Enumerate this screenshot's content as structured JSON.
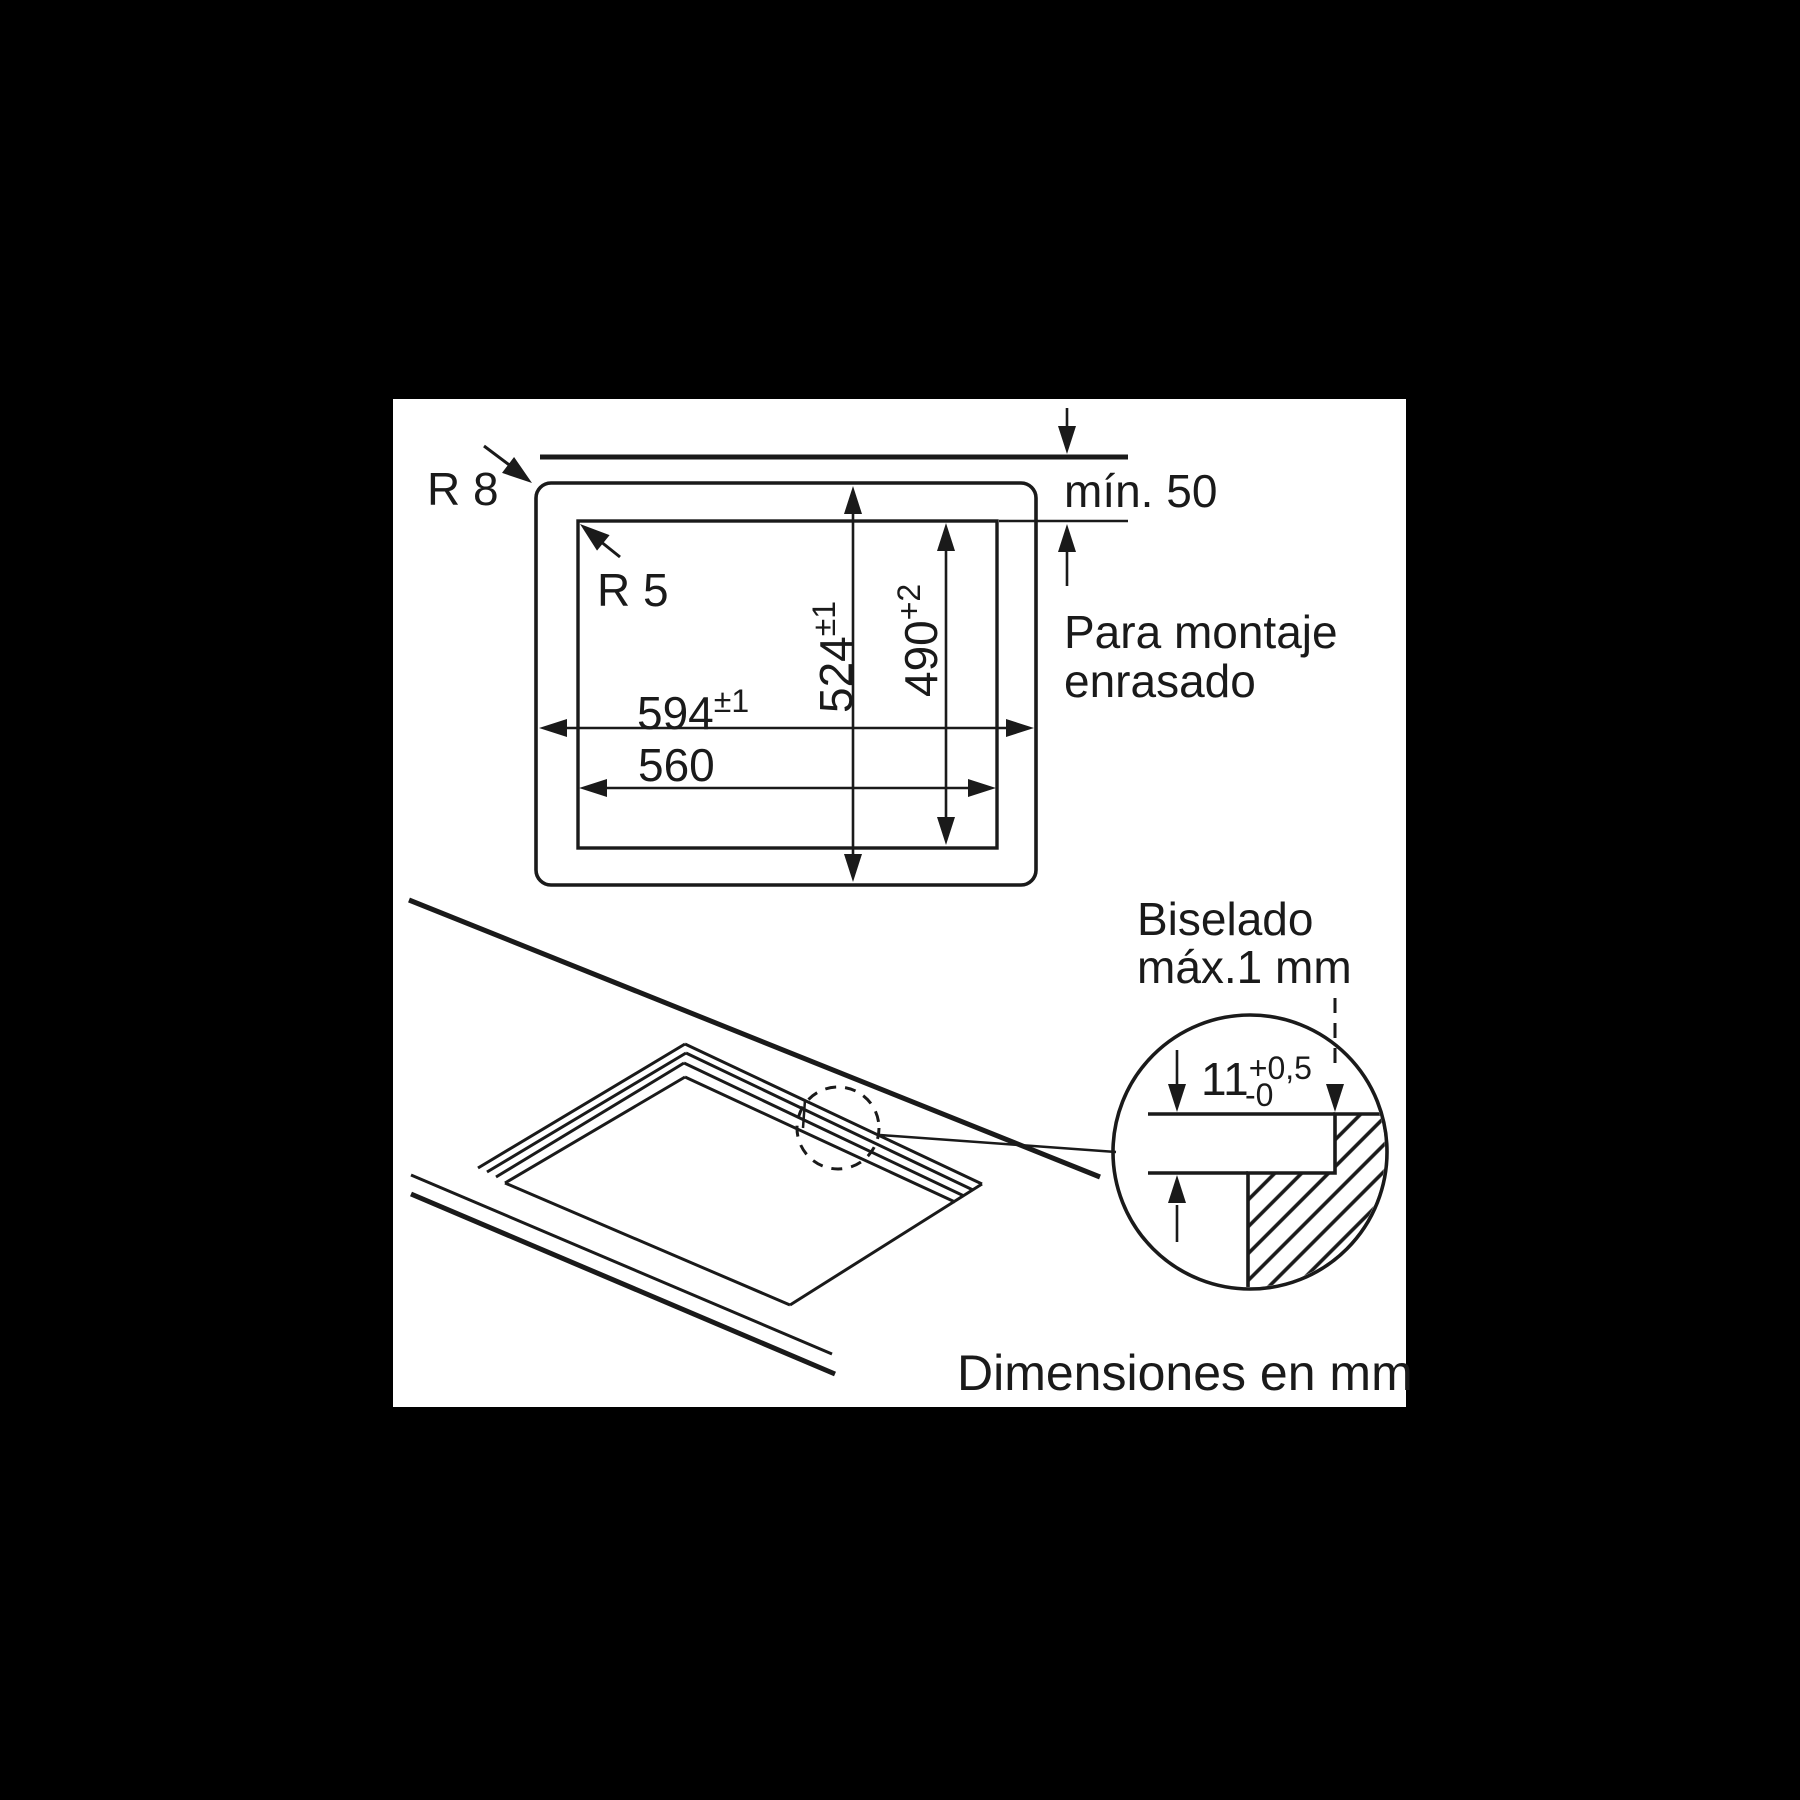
{
  "colors": {
    "page_bg": "#000000",
    "canvas_bg": "#ffffff",
    "line": "#1a1a1a"
  },
  "top_view": {
    "outer_corner_radius": "R 8",
    "inner_corner_radius": "R 5",
    "min_clearance": "mín. 50",
    "hob_width": "594",
    "hob_width_tol": "±1",
    "cutout_width": "560",
    "hob_depth": "524",
    "hob_depth_tol": "±1",
    "cutout_depth": "490",
    "cutout_depth_tol": "+2",
    "flush_note_line1": "Para montaje",
    "flush_note_line2": "enrasado"
  },
  "detail_view": {
    "bevel_note_line1": "Biselado",
    "bevel_note_line2": "máx.1 mm",
    "recess_depth": "11",
    "recess_tol_plus": "+0,5",
    "recess_tol_minus": "-0"
  },
  "footer": {
    "units_note": "Dimensiones en mm"
  }
}
